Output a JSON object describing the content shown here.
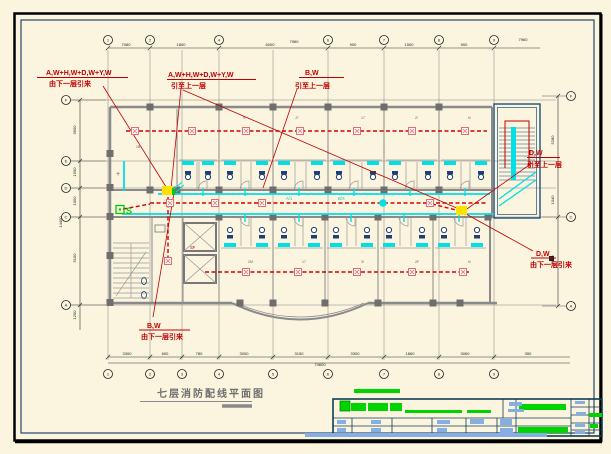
{
  "drawing_title": "七层消防配线平面图",
  "annotations": {
    "a1": {
      "line1": "A,W+H,W+D,W+Y,W",
      "line2": "由下一层引来"
    },
    "a2": {
      "line1": "A,W+H,W+D,W+Y,W",
      "line2": "引至上一层"
    },
    "a3": {
      "line1": "B,W",
      "line2": "引至上一层"
    },
    "a4": {
      "line1": "D,W",
      "line2": "引至上一层"
    },
    "a5": {
      "line1": "D,W",
      "line2": "由下一层引来"
    },
    "a6": {
      "line1": "B,W",
      "line2": "由下一层引来"
    }
  },
  "corridor_labels": {
    "l1": "A/1",
    "l2": "B/X",
    "l3": "SF"
  },
  "symbols": {
    "sounder": "S"
  },
  "colors": {
    "red": "#C00000",
    "pink": "#E07070",
    "pink_fill": "#FFF6F6",
    "cyan": "#00E0E6",
    "green": "#00CC00",
    "yellow": "#FFE100",
    "navy": "#1F3F77",
    "wall_gray": "#8A8A8A",
    "column_gray": "#6E6E6E",
    "frame_black": "#000000",
    "frame_navy": "#27456B",
    "tb_border": "#0E3D55",
    "tb_blue": "#85AEE4",
    "tb_green": "#00D400",
    "title_gray": "#6F6F6F"
  },
  "axes": {
    "top": {
      "cy": 40,
      "items": [
        {
          "x": 108,
          "l": "1"
        },
        {
          "x": 150,
          "l": "2"
        },
        {
          "x": 219,
          "l": "4"
        },
        {
          "x": 328,
          "l": "6"
        },
        {
          "x": 384,
          "l": "7"
        },
        {
          "x": 439,
          "l": "8"
        },
        {
          "x": 494,
          "l": "9"
        }
      ]
    },
    "bottom": {
      "cy": 374,
      "items": [
        {
          "x": 108,
          "l": "1"
        },
        {
          "x": 150,
          "l": "2"
        },
        {
          "x": 182,
          "l": "3"
        },
        {
          "x": 219,
          "l": "4"
        },
        {
          "x": 273,
          "l": "5"
        },
        {
          "x": 328,
          "l": "6"
        },
        {
          "x": 384,
          "l": "7"
        },
        {
          "x": 439,
          "l": "8"
        },
        {
          "x": 494,
          "l": "9"
        }
      ]
    },
    "left": {
      "cx": 66,
      "items": [
        {
          "y": 100,
          "l": "F"
        },
        {
          "y": 161,
          "l": "E"
        },
        {
          "y": 188,
          "l": "D"
        },
        {
          "y": 217,
          "l": "C"
        },
        {
          "y": 305,
          "l": "A"
        }
      ]
    },
    "right": {
      "cx": 571,
      "items": [
        {
          "y": 96,
          "l": "F"
        },
        {
          "y": 217,
          "l": "C"
        },
        {
          "y": 306,
          "l": "A"
        }
      ]
    }
  },
  "dims": {
    "top": {
      "y": 46,
      "items": [
        {
          "x": 126,
          "t": "7080"
        },
        {
          "x": 181,
          "t": "1800"
        },
        {
          "x": 270,
          "t": "6000"
        },
        {
          "x": 353,
          "t": "900"
        },
        {
          "x": 409,
          "t": "1500"
        },
        {
          "x": 464,
          "t": "900"
        }
      ]
    },
    "bottom": {
      "y": 355,
      "items": [
        {
          "x": 127,
          "t": "3300"
        },
        {
          "x": 165,
          "t": "600"
        },
        {
          "x": 199,
          "t": "780"
        },
        {
          "x": 244,
          "t": "3000"
        },
        {
          "x": 299,
          "t": "3150"
        },
        {
          "x": 355,
          "t": "3300"
        },
        {
          "x": 410,
          "t": "1860"
        },
        {
          "x": 465,
          "t": "3060"
        },
        {
          "x": 528,
          "t": "350"
        }
      ]
    },
    "left": {
      "x": 76,
      "items": [
        {
          "y": 130,
          "t": "3600"
        },
        {
          "y": 172,
          "t": "1500"
        },
        {
          "y": 201,
          "t": "1050"
        },
        {
          "y": 258,
          "t": "5100"
        },
        {
          "y": 315,
          "t": "1200"
        }
      ]
    },
    "right": {
      "x": 554,
      "items": [
        {
          "y": 140,
          "t": "5280"
        },
        {
          "y": 200,
          "t": "1040"
        },
        {
          "y": 260,
          "t": "2640"
        }
      ]
    },
    "totals": [
      {
        "x": 294,
        "y": 43,
        "t": "7960"
      },
      {
        "x": 523,
        "y": 41,
        "t": "7960"
      },
      {
        "x": 320,
        "y": 366,
        "t": "74600"
      },
      {
        "x": 62,
        "y": 222,
        "t": "14400",
        "rot": true
      }
    ]
  },
  "detectors": {
    "top_row": [
      {
        "x": 135,
        "y": 131
      },
      {
        "x": 192,
        "y": 131
      },
      {
        "x": 246,
        "y": 131
      },
      {
        "x": 300,
        "y": 131
      },
      {
        "x": 357,
        "y": 131
      },
      {
        "x": 412,
        "y": 131
      },
      {
        "x": 465,
        "y": 131
      }
    ],
    "corridor_row": [
      {
        "x": 170,
        "y": 203
      },
      {
        "x": 215,
        "y": 203
      },
      {
        "x": 262,
        "y": 203
      },
      {
        "x": 430,
        "y": 203
      }
    ],
    "bottom_row": [
      {
        "x": 246,
        "y": 272
      },
      {
        "x": 298,
        "y": 272
      },
      {
        "x": 357,
        "y": 272
      },
      {
        "x": 412,
        "y": 272
      },
      {
        "x": 463,
        "y": 272
      }
    ],
    "extra": [
      {
        "x": 168,
        "y": 261
      }
    ]
  },
  "rooms": {
    "top": [
      {
        "x": 177,
        "w": 42
      },
      {
        "x": 219,
        "w": 54
      },
      {
        "x": 273,
        "w": 55
      },
      {
        "x": 328,
        "w": 56
      },
      {
        "x": 384,
        "w": 55
      },
      {
        "x": 439,
        "w": 53
      }
    ],
    "bottom": [
      {
        "x": 219,
        "w": 54
      },
      {
        "x": 273,
        "w": 52
      },
      {
        "x": 325,
        "w": 53
      },
      {
        "x": 378,
        "w": 55
      },
      {
        "x": 433,
        "w": 55
      }
    ]
  },
  "room_labels": [
    {
      "x": 243,
      "y": 119,
      "t": "N"
    },
    {
      "x": 295,
      "y": 119,
      "t": "J7"
    },
    {
      "x": 361,
      "y": 119,
      "t": "17"
    },
    {
      "x": 415,
      "y": 119,
      "t": "2!"
    },
    {
      "x": 468,
      "y": 119,
      "t": "N"
    },
    {
      "x": 248,
      "y": 263,
      "t": "2M"
    },
    {
      "x": 302,
      "y": 263,
      "t": "17"
    },
    {
      "x": 361,
      "y": 263,
      "t": "3!"
    },
    {
      "x": 415,
      "y": 263,
      "t": "2F"
    },
    {
      "x": 468,
      "y": 263,
      "t": "N"
    },
    {
      "x": 116,
      "y": 176,
      "t": "+",
      "s": 7
    },
    {
      "x": 136,
      "y": 148,
      "t": "1B"
    }
  ],
  "title_block": {
    "green_bars": [
      [
        340,
        401,
        10,
        10
      ],
      [
        351,
        403,
        15,
        8
      ],
      [
        368,
        403,
        20,
        8
      ],
      [
        390,
        403,
        12,
        8
      ],
      [
        405,
        410,
        57,
        3
      ],
      [
        467,
        410,
        24,
        3
      ],
      [
        519,
        404,
        47,
        6
      ],
      [
        589,
        413,
        13,
        4
      ],
      [
        518,
        427,
        50,
        6
      ],
      [
        590,
        424,
        8,
        4
      ],
      [
        354,
        389,
        46,
        4
      ]
    ],
    "blue_bars": [
      [
        509,
        402,
        13,
        4
      ],
      [
        508,
        409,
        16,
        3
      ],
      [
        337,
        420,
        9,
        4
      ],
      [
        371,
        420,
        10,
        4
      ],
      [
        437,
        420,
        13,
        4
      ],
      [
        470,
        419,
        14,
        5
      ],
      [
        500,
        419,
        12,
        6
      ],
      [
        337,
        428,
        9,
        4
      ],
      [
        371,
        428,
        10,
        4
      ],
      [
        437,
        428,
        10,
        4
      ],
      [
        500,
        428,
        13,
        5
      ],
      [
        575,
        401,
        10,
        3
      ],
      [
        576,
        412,
        10,
        3
      ],
      [
        575,
        424,
        10,
        3
      ],
      [
        575,
        431,
        10,
        3
      ],
      [
        305,
        433,
        242,
        4
      ]
    ]
  }
}
